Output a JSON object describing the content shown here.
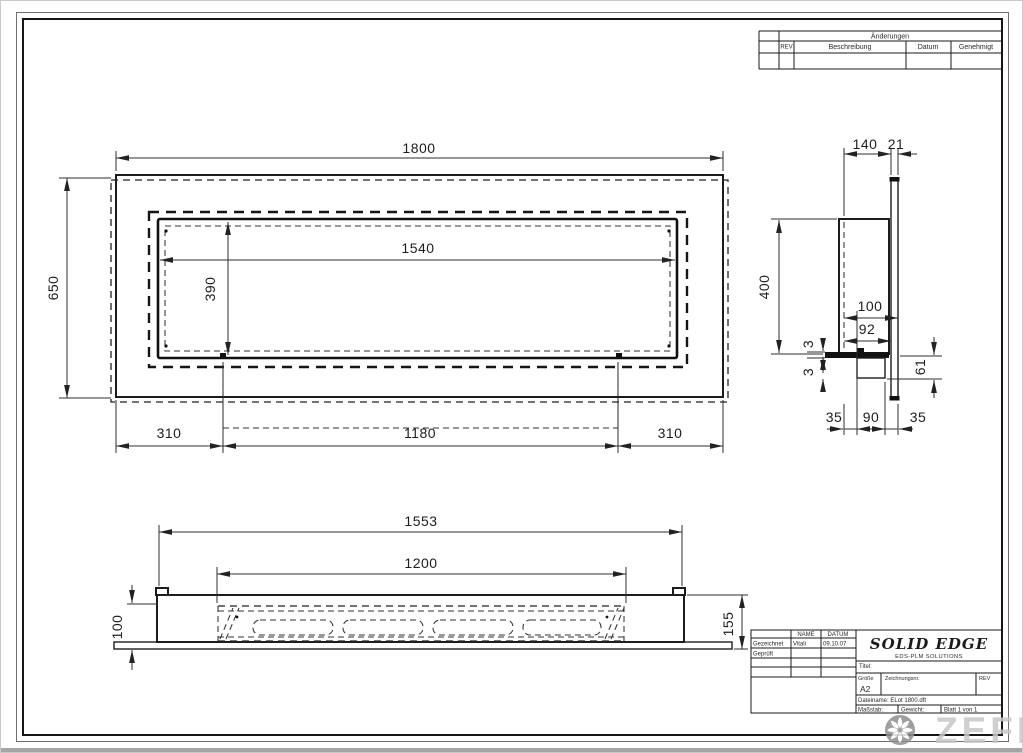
{
  "revision_table": {
    "header": "Änderungen",
    "col_rev": "REV",
    "col_desc": "Beschreibung",
    "col_date": "Datum",
    "col_appr": "Genehmigt"
  },
  "front_view": {
    "dim_width": "1800",
    "dim_height": "650",
    "dim_opening_w": "1540",
    "dim_opening_h": "390",
    "dim_left": "310",
    "dim_center": "1180",
    "dim_right": "310"
  },
  "side_view": {
    "dim_depth": "140",
    "dim_glass": "21",
    "dim_height": "400",
    "dim_100": "100",
    "dim_92": "92",
    "dim_3a": "3",
    "dim_3b": "3",
    "dim_61": "61",
    "dim_35a": "35",
    "dim_90": "90",
    "dim_35b": "35"
  },
  "bottom_view": {
    "dim_total": "1553",
    "dim_burner": "1200",
    "dim_100": "100",
    "dim_155": "155"
  },
  "title_block": {
    "col_name": "NAME",
    "col_date": "DATUM",
    "row1_label": "Gezeichnet",
    "row1_name": "Vitali",
    "row1_date": "09.10.07",
    "row2_label": "Geprüft",
    "brand": "SOLID EDGE",
    "brand_sub": "EDS-PLM SOLUTIONS",
    "title_label": "Titel:",
    "size_label": "Größe",
    "size_value": "A2",
    "doc_label": "Zeichnungsnr.",
    "rev_label": "REV",
    "filename": "Dateiname: ELot 1800.dft",
    "scale_label": "Maßstab:",
    "weight_label": "Gewicht:",
    "sheet_label": "Blatt 1 von 1"
  },
  "watermark": {
    "brand": "ZEFIRE"
  }
}
